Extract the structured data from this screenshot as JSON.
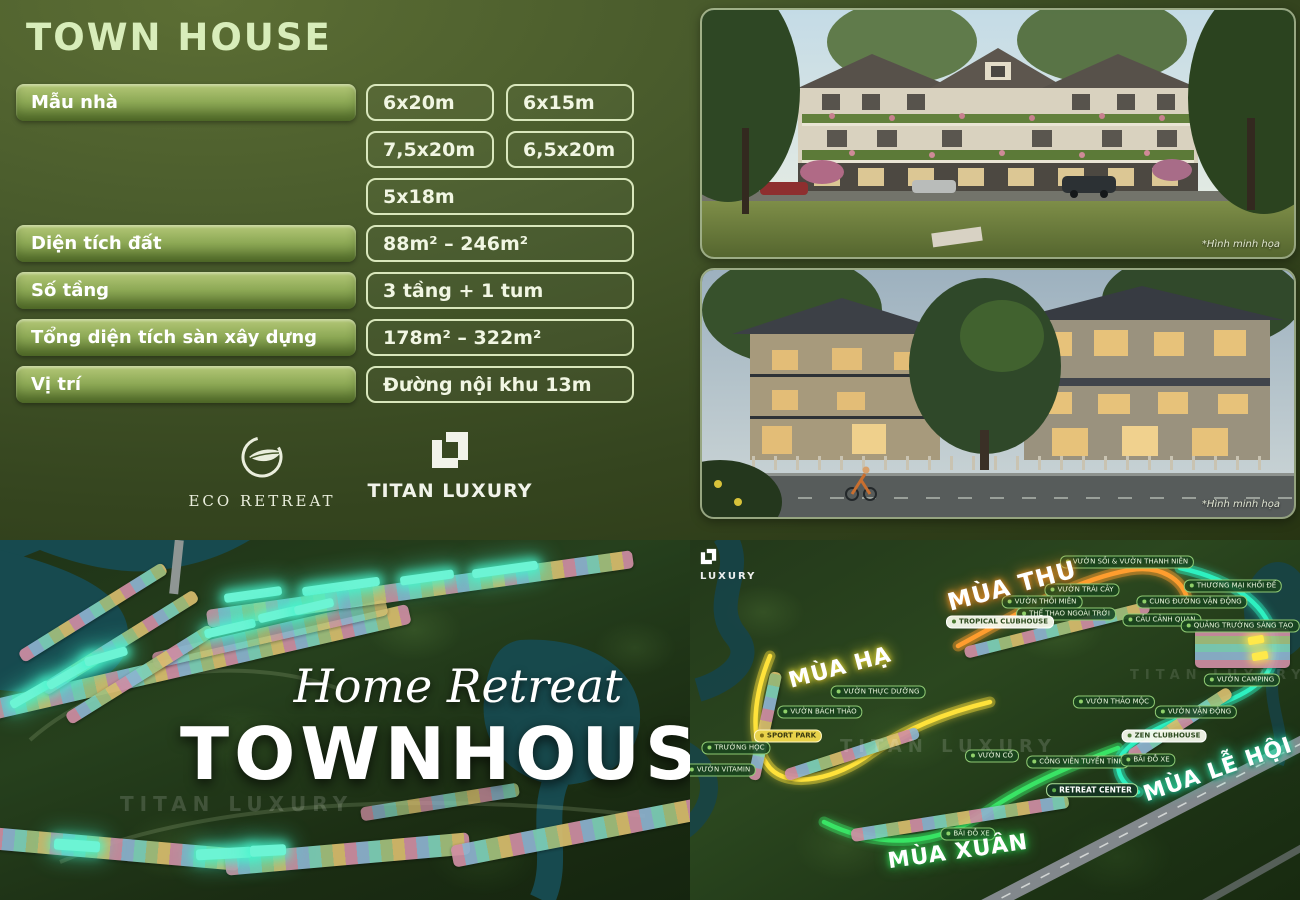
{
  "header": {
    "title": "TOWN HOUSE"
  },
  "table": {
    "rows": [
      {
        "label": "Mẫu nhà",
        "values": [
          "6x20m",
          "6x15m",
          "7,5x20m",
          "6,5x20m",
          "5x18m"
        ]
      },
      {
        "label": "Diện tích đất",
        "values": [
          "88m² – 246m²"
        ]
      },
      {
        "label": "Số tầng",
        "values": [
          "3 tầng + 1 tum"
        ]
      },
      {
        "label": "Tổng diện tích sàn xây dựng",
        "values": [
          "178m² – 322m²"
        ]
      },
      {
        "label": "Vị trí",
        "values": [
          "Đường nội khu 13m"
        ]
      }
    ]
  },
  "brand": {
    "eco_retreat": "ECO RETREAT",
    "titan_luxury": "TITAN LUXURY",
    "luxury_small": "LUXURY"
  },
  "photos": {
    "caption": "*Hình minh họa"
  },
  "left_map": {
    "script_title": "Home Retreat",
    "main_title": "TOWNHOUSE",
    "watermark": "TITAN LUXURY"
  },
  "right_map": {
    "watermark": "TITAN LUXURY",
    "season_labels": [
      {
        "text": "MÙA HẠ",
        "glow": "#f5e73a",
        "x": 150,
        "y": 128,
        "rot": -15,
        "size": 22
      },
      {
        "text": "MÙA THU",
        "glow": "#ff9b2a",
        "x": 322,
        "y": 46,
        "rot": -15,
        "size": 24
      },
      {
        "text": "MÙA XUÂN",
        "glow": "#35e05a",
        "x": 268,
        "y": 312,
        "rot": -8,
        "size": 22
      },
      {
        "text": "MÙA LỄ HỘI",
        "glow": "#2df0b8",
        "x": 528,
        "y": 230,
        "rot": -19,
        "size": 22
      }
    ],
    "pois": [
      {
        "text": "VƯỜN SỒI & VƯỜN THANH NIÊN",
        "x": 437,
        "y": 22
      },
      {
        "text": "VƯỜN TRÁI CÂY",
        "x": 392,
        "y": 50
      },
      {
        "text": "THỂ THAO NGOÀI TRỜI",
        "x": 376,
        "y": 74
      },
      {
        "text": "CẦU CẢNH QUAN",
        "x": 472,
        "y": 80
      },
      {
        "text": "CUNG ĐƯỜNG VẬN ĐỘNG",
        "x": 502,
        "y": 62
      },
      {
        "text": "THƯƠNG MẠI KHỐI ĐẾ",
        "x": 543,
        "y": 46
      },
      {
        "text": "QUẢNG TRƯỜNG SÁNG TẠO",
        "x": 550,
        "y": 86
      },
      {
        "text": "VƯỜN CAMPING",
        "x": 552,
        "y": 140
      },
      {
        "text": "TROPICAL CLUBHOUSE",
        "x": 310,
        "y": 82,
        "variant": "light"
      },
      {
        "text": "VƯỜN THÔI MIÊN",
        "x": 352,
        "y": 62
      },
      {
        "text": "VƯỜN THẢO MỘC",
        "x": 424,
        "y": 162
      },
      {
        "text": "VƯỜN VẬN ĐỘNG",
        "x": 506,
        "y": 172
      },
      {
        "text": "ZEN CLUBHOUSE",
        "x": 474,
        "y": 196,
        "variant": "light"
      },
      {
        "text": "RETREAT CENTER",
        "x": 402,
        "y": 250,
        "variant": "dark"
      },
      {
        "text": "CÔNG VIÊN TUYẾN TÍNH",
        "x": 388,
        "y": 222
      },
      {
        "text": "BÃI ĐỖ XE",
        "x": 458,
        "y": 220
      },
      {
        "text": "VƯỜN CỔ",
        "x": 302,
        "y": 216
      },
      {
        "text": "BÃI ĐỖ XE",
        "x": 278,
        "y": 294
      },
      {
        "text": "TRƯỜNG HỌC",
        "x": 46,
        "y": 208
      },
      {
        "text": "SPORT PARK",
        "x": 98,
        "y": 196,
        "variant": "yellow"
      },
      {
        "text": "VƯỜN BÁCH THẢO",
        "x": 130,
        "y": 172
      },
      {
        "text": "VƯỜN THỰC DƯỠNG",
        "x": 188,
        "y": 152
      },
      {
        "text": "VƯỜN VITAMIN",
        "x": 30,
        "y": 230
      }
    ]
  },
  "colors": {
    "panel_green": "#47592b",
    "title_green": "#d8edba",
    "pill_gradient_top": "#b4c878",
    "pill_gradient_bottom": "#5f7a32",
    "value_border": "#d9e7bc",
    "water": "#174a4f",
    "route_yellow": "#ffe23a",
    "route_orange": "#ff9d2e",
    "route_green": "#39e465",
    "route_teal": "#2df0c0",
    "highlight_cyan": "#6cf4d4"
  }
}
